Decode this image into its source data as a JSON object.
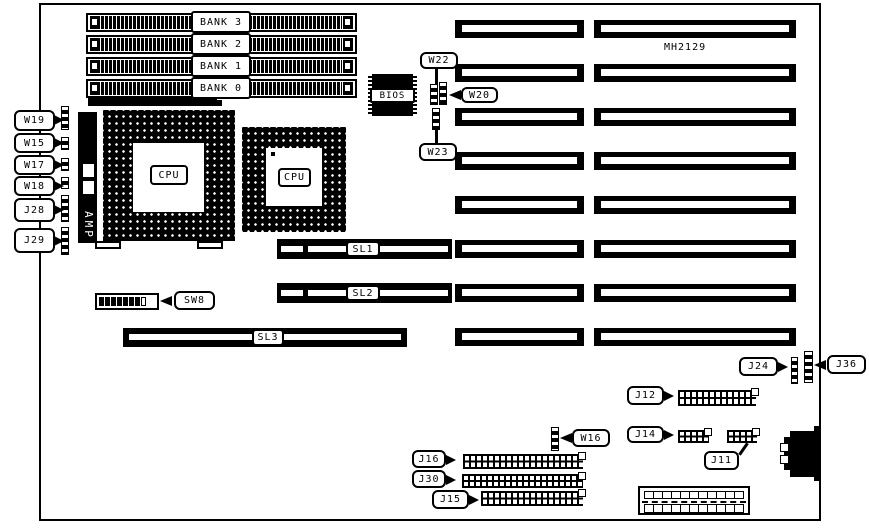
{
  "board": {
    "part_number": "MH2129"
  },
  "banks": {
    "bank3": "BANK 3",
    "bank2": "BANK 2",
    "bank1": "BANK 1",
    "bank0": "BANK 0"
  },
  "chips": {
    "cpu1": "CPU",
    "cpu2": "CPU",
    "amp": "AMP",
    "bios": "BIOS"
  },
  "slots": {
    "sl1": "SL1",
    "sl2": "SL2",
    "sl3": "SL3"
  },
  "switches": {
    "sw8": "SW8"
  },
  "jumpers": {
    "w19": "W19",
    "w15": "W15",
    "w17": "W17",
    "w18": "W18",
    "j28": "J28",
    "j29": "J29",
    "w22": "W22",
    "w20": "W20",
    "w23": "W23",
    "w16": "W16"
  },
  "connectors": {
    "j24": "J24",
    "j36": "J36",
    "j12": "J12",
    "j14": "J14",
    "j11": "J11",
    "j16": "J16",
    "j30": "J30",
    "j15": "J15"
  }
}
